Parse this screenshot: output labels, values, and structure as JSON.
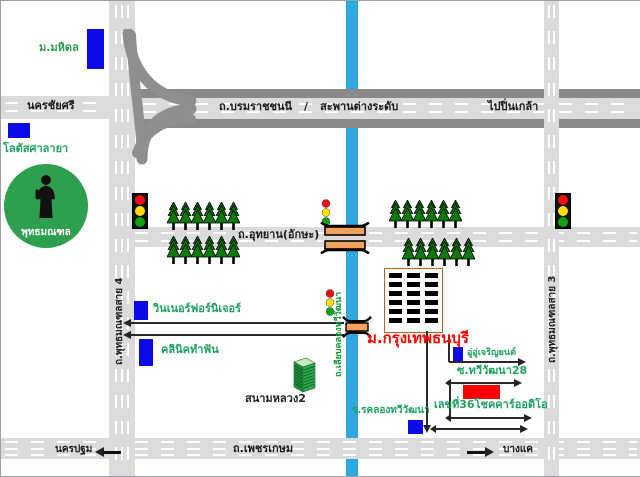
{
  "colors": {
    "canal_blue": "#2EA8E0",
    "road_light_gray": "#DBDBDB",
    "road_dark_gray": "#8A8A8A",
    "landmark_blue": "#0B0BE8",
    "highlight_red": "#FF0000",
    "tree_green": "#0A7A0A",
    "monument_green": "#2E9E4F",
    "label_green": "#1FA060",
    "bridge_orange": "#EFA35C"
  },
  "roads": {
    "nakhon_chai_si": "นครชัยศรี",
    "borommaratchachonnani": "ถ.บรมราชชนนี",
    "separator": "/",
    "overpass": "สะพานต่างระดับ",
    "to_pinklao": "ไปปิ่นเกล้า",
    "utthayan": "ถ.อุทยาน(อักษะ)",
    "sai4": "ถ.พุทธมณฑลสาย 4",
    "sai3": "ถ.พุทธมณฑลสาย 3",
    "liap_khlong": "ถ.เลียบคลองทวีวัฒนา",
    "phetkasem": "ถ.เพชรเกษม",
    "west_destination": "นครปฐม",
    "east_destination": "บางแค"
  },
  "landmarks": {
    "mahidol": "ม.มหิดล",
    "lotus": "โลตัสศาลายา",
    "phutthamonthon": "พุทธมณฑล",
    "winner_furniture": "วินเนอร์ฟอร์นิเจอร์",
    "dental_clinic": "คลินิคทำฟัน",
    "university": "ม.กรุงเทพธนบุรี",
    "garage": "อู่อู่เจริญยนต์",
    "soi28": "ซ.ทวีวัฒนา28",
    "car_audio": "เลขที่36โชคคาร์ออดิโอ",
    "school": "ร.รคลองทวีวัฒนา",
    "sanam_luang2": "สนามหลวง2"
  }
}
